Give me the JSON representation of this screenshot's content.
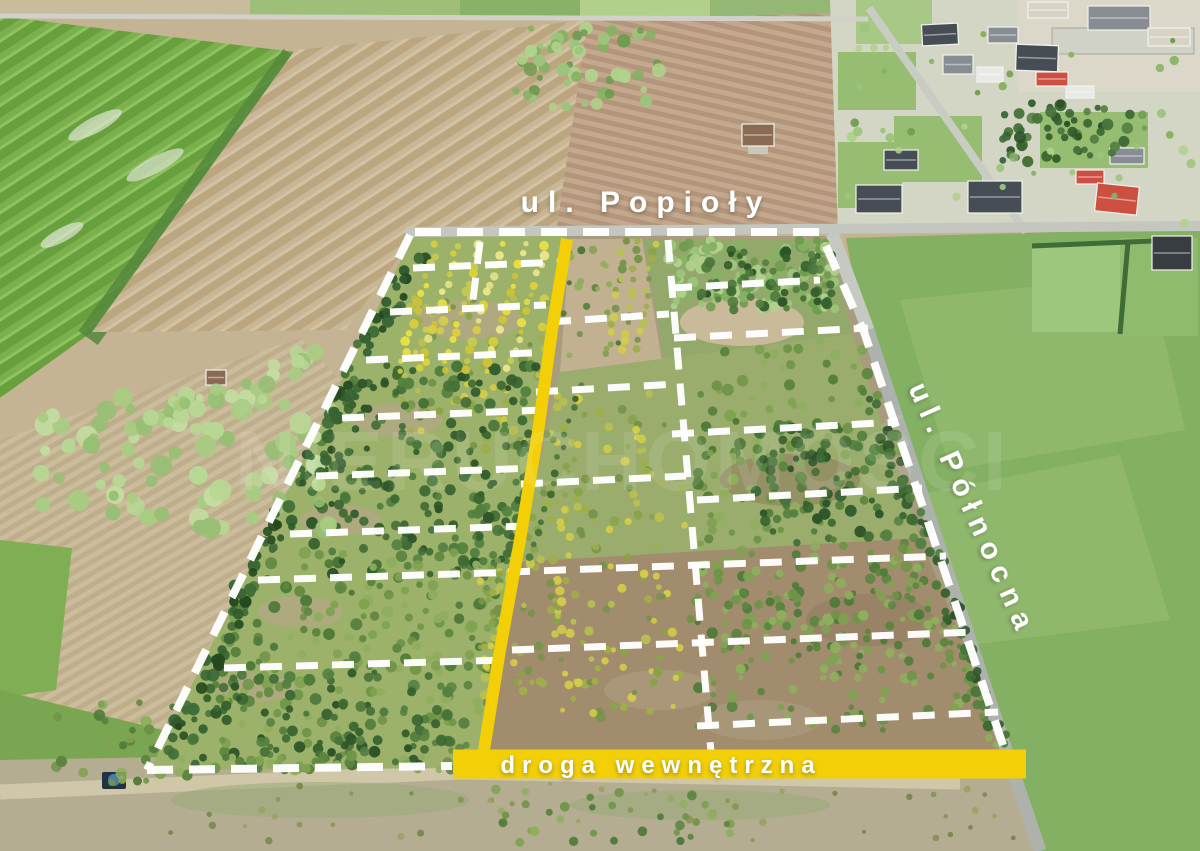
{
  "canvas": {
    "width": 1200,
    "height": 851
  },
  "labels": {
    "street_top": "ul. Popioły",
    "street_right": "ul. Północna",
    "internal_road": "droga wewnętrzna",
    "watermark": "NIERUCHOMOŚCI"
  },
  "colors": {
    "annotation_yellow": "#F2CF07",
    "boundary_dash_white": "#FFFFFF",
    "label_text_white": "#FFFFFF",
    "asphalt_road_gray": "#ADB2AC",
    "meadow_green": "#83B062",
    "plowed_field_tan": "#C5B493",
    "conifer_green": "#3D6A33"
  }
}
